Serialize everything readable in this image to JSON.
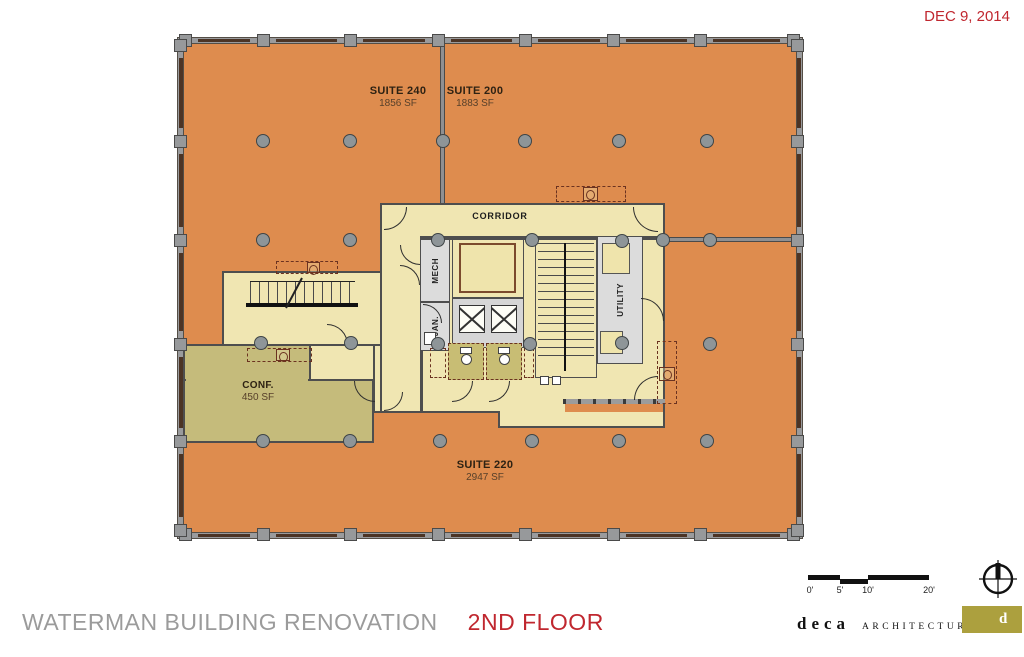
{
  "sheet": {
    "date": "DEC 9, 2014",
    "project_title": "WATERMAN BUILDING RENOVATION",
    "sheet_title": "2ND FLOOR"
  },
  "plan": {
    "suites": [
      {
        "name": "SUITE 240",
        "area": "1856 SF"
      },
      {
        "name": "SUITE 200",
        "area": "1883 SF"
      },
      {
        "name": "SUITE 220",
        "area": "2947 SF"
      }
    ],
    "rooms": {
      "corridor": "CORRIDOR",
      "mech": "MECH",
      "jan": "JAN.",
      "utility": "UTILITY",
      "conf_name": "CONF.",
      "conf_area": "450 SF"
    }
  },
  "scale_bar": {
    "labels": [
      "0'",
      "5'",
      "10'",
      "20'"
    ]
  },
  "firm": {
    "name": "deca",
    "descriptor": "ARCHITECTURE INC",
    "mark": "d"
  },
  "colors": {
    "suite_fill": "#DE8C4E",
    "core_fill": "#F0E6B2",
    "conf_fill": "#C5BB7B",
    "wall_gray": "#9A9B9D",
    "accent_red": "#C0272F",
    "title_gray": "#9B9B9B",
    "logo_olive": "#ACA03E",
    "casework_brown": "#6b3220"
  }
}
